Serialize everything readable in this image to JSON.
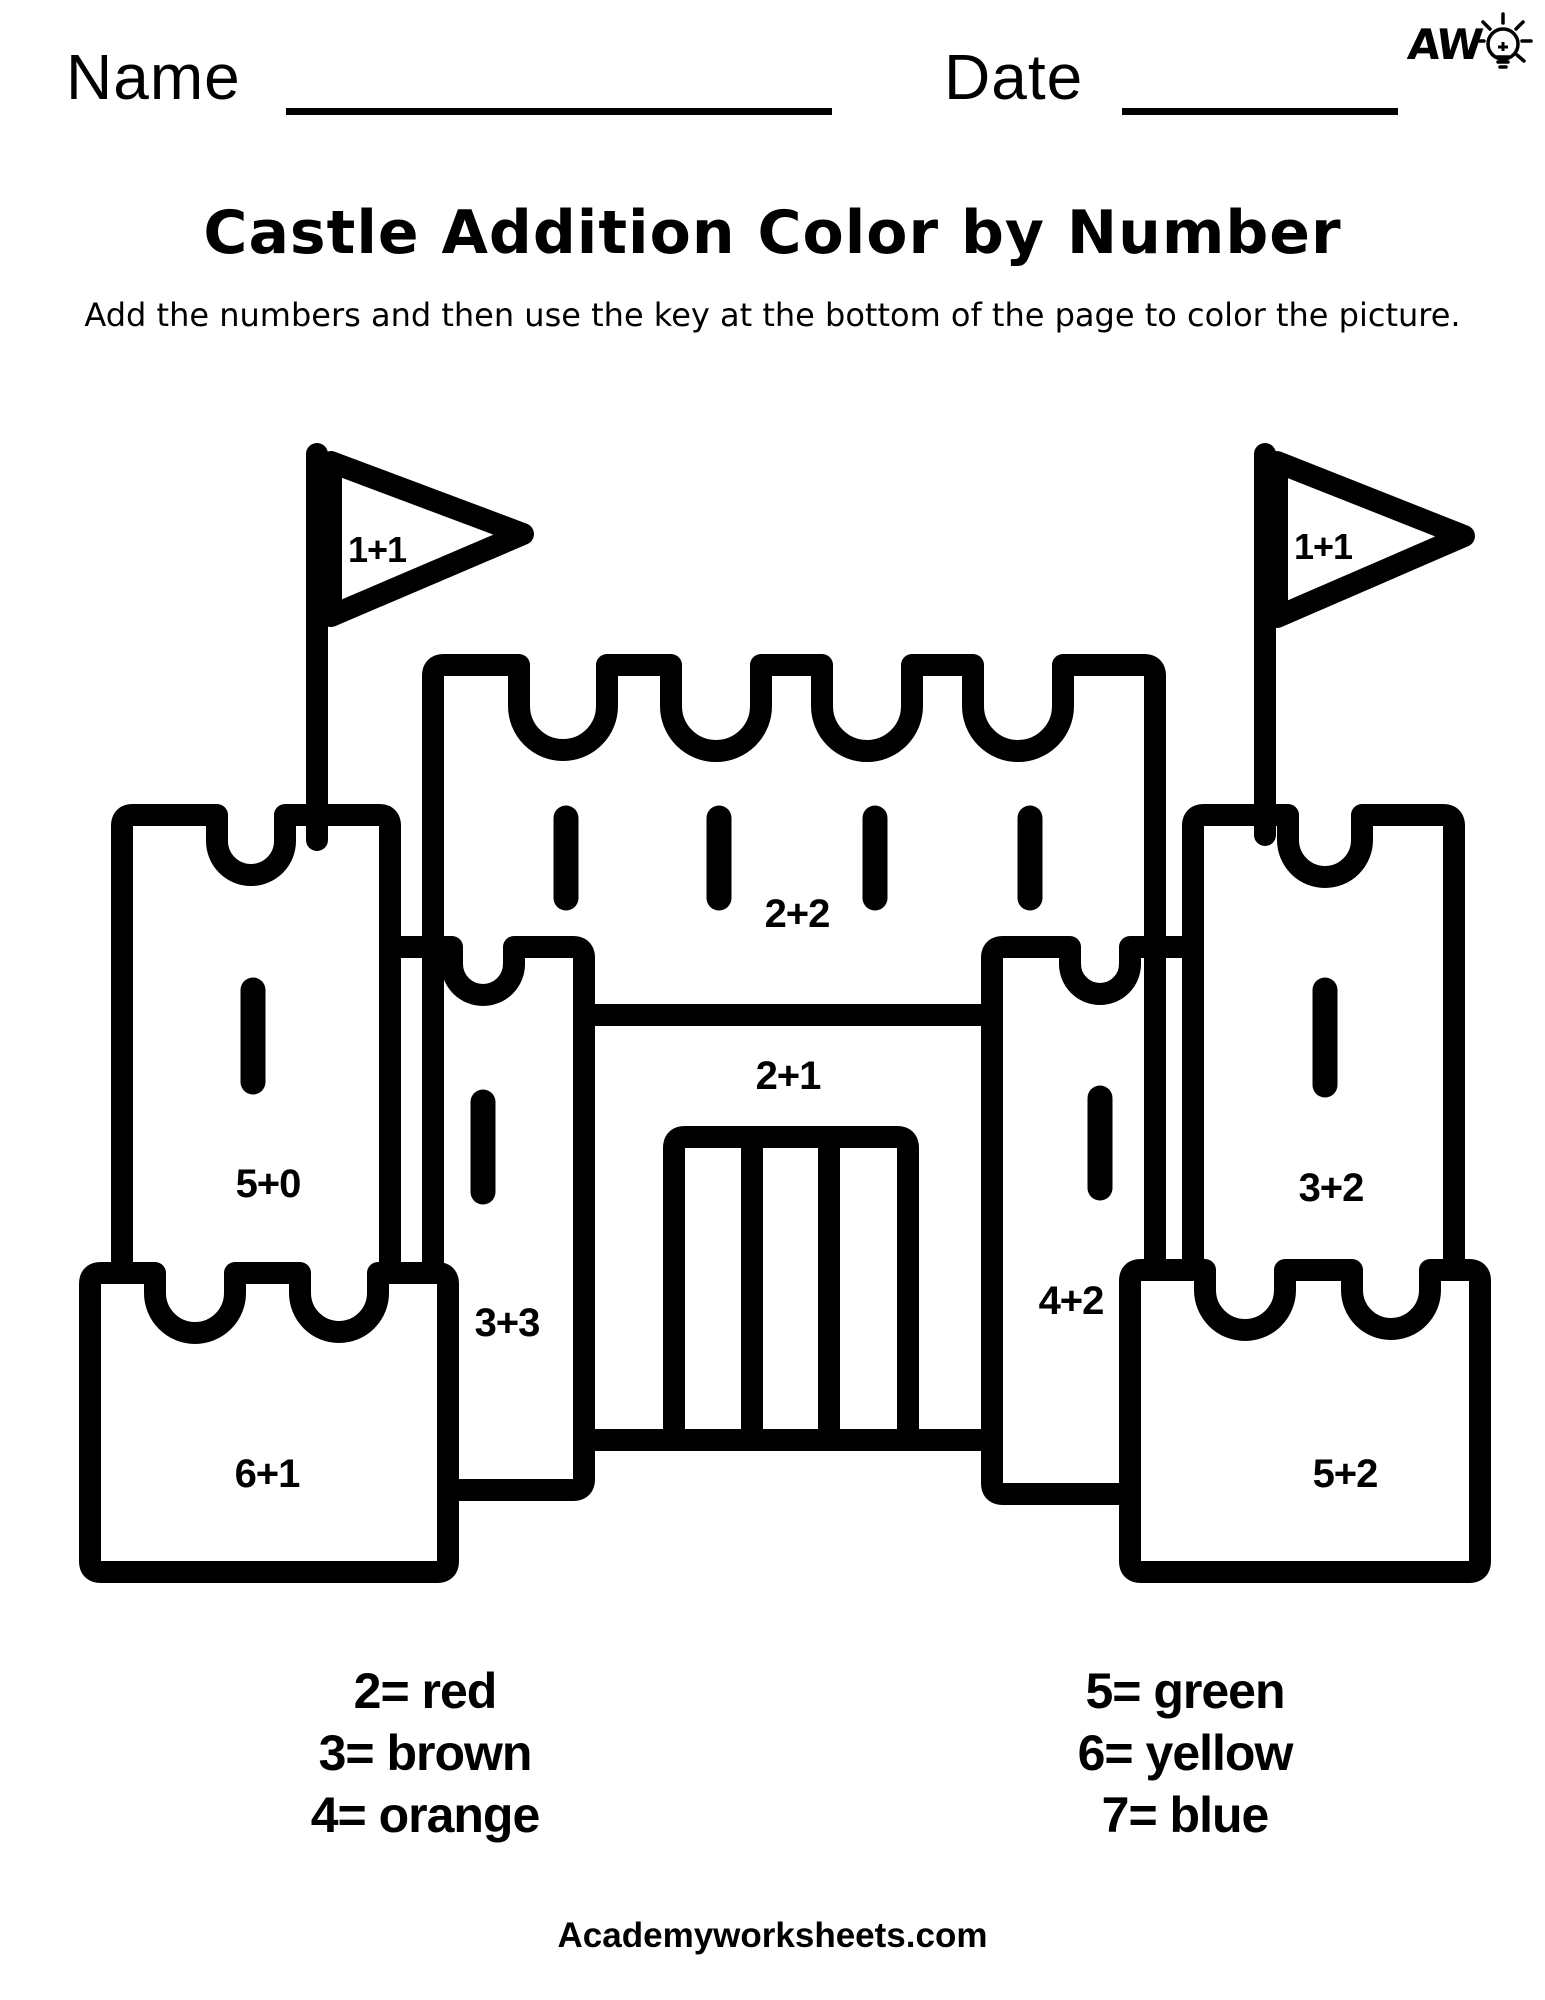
{
  "header": {
    "name_label": "Name",
    "date_label": "Date"
  },
  "logo": {
    "text": "AW",
    "icon": "lightbulb-doodle-icon"
  },
  "title": "Castle Addition Color by Number",
  "instructions": "Add the numbers and then use the key at the bottom of the page to color the picture.",
  "castle": {
    "labels": {
      "flag_left": "1+1",
      "flag_right": "1+1",
      "main_wall": "2+2",
      "gate_wall": "2+1",
      "tower_left": "5+0",
      "tower_right": "3+2",
      "inner_tower_left": "3+3",
      "inner_tower_right": "4+2",
      "base_left": "6+1",
      "base_right": "5+2"
    }
  },
  "color_key": {
    "left_column": [
      "2= red",
      "3= brown",
      "4= orange"
    ],
    "right_column": [
      "5= green",
      "6= yellow",
      "7= blue"
    ]
  },
  "footer": "Academyworksheets.com",
  "colors": {
    "ink": "#000000",
    "paper": "#ffffff"
  }
}
